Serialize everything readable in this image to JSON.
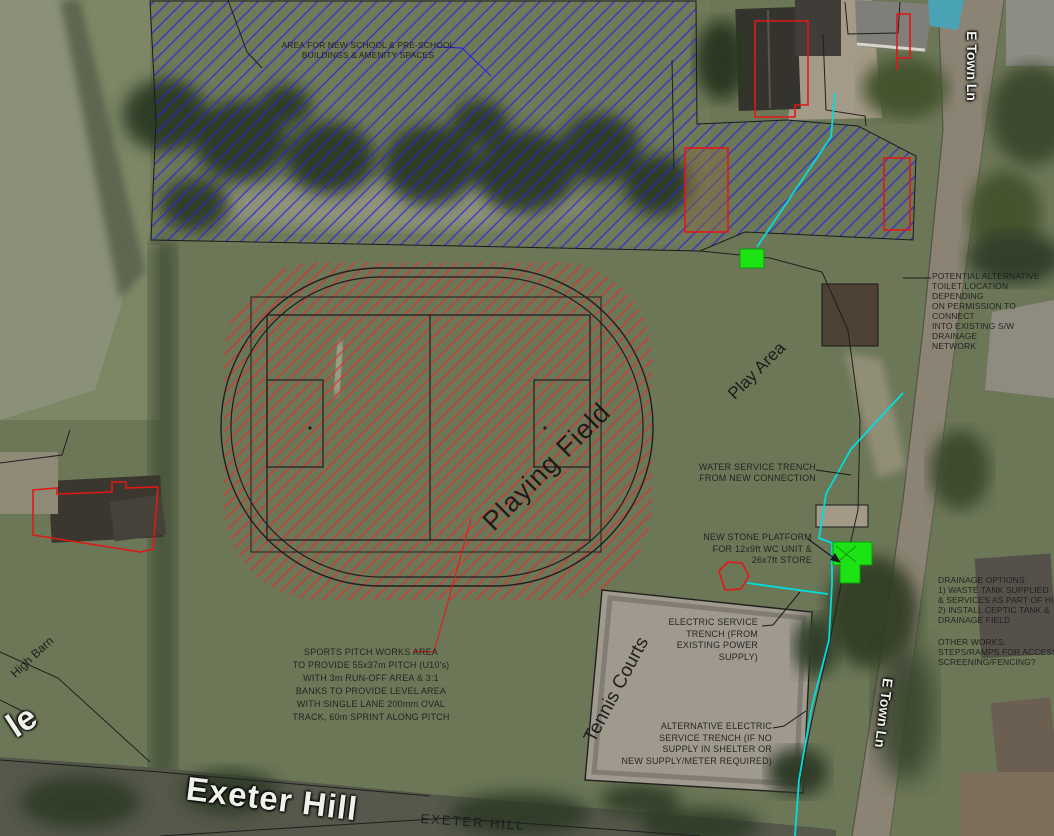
{
  "canvas": {
    "width": 1054,
    "height": 836
  },
  "annotations": {
    "school_area": "AREA FOR NEW SCHOOL & PRE-SCHOOL\nBUILDINGS & AMENITY SPACES",
    "toilet_location": "POTENTIAL ALTERNATIVE\nTOILET LOCATION DEPENDING\nON PERMISSION TO CONNECT\nINTO EXISTING S/W DRAINAGE\nNETWORK",
    "water_trench": "WATER SERVICE TRENCH\nFROM NEW CONNECTION",
    "stone_platform": "NEW STONE PLATFORM\nFOR 12x9ft WC UNIT &\n26x7ft STORE",
    "drainage_options": "DRAINAGE OPTIONS:\n1) WASTE TANK SUPPLIED\n& SERVICES AS PART OF HI\n2) INSTALL CEPTIC TANK &\nDRAINAGE FIELD",
    "other_works": "OTHER WORKS:\nSTEPS/RAMPS FOR ACCESS\nSCREENING/FENCING?",
    "electric_trench": "ELECTRIC SERVICE\nTRENCH (FROM\nEXISTING POWER SUPPLY)",
    "alt_electric_trench": "ALTERNATIVE ELECTRIC\nSERVICE TRENCH (IF NO\nSUPPLY IN SHELTER OR\nNEW SUPPLY/METER REQUIRED)",
    "sports_pitch": "SPORTS PITCH WORKS AREA\nTO PROVIDE 55x37m PITCH (U10's)\nWITH 3m RUN-OFF AREA & 3:1\nBANKS TO PROVIDE LEVEL AREA\nWITH SINGLE LANE 200mm OVAL\nTRACK, 60m SPRINT ALONG PITCH"
  },
  "site_labels": {
    "playing_field": "Playing Field",
    "play_area": "Play Area",
    "tennis_courts": "Tennis Courts",
    "high_barn": "High Barn"
  },
  "road_labels": {
    "exeter_hill_photo": "Exeter Hill",
    "exeter_hill_cad": "EXETER HILL",
    "e_town_ln_north": "E Town Ln",
    "e_town_ln_south": "E Town Ln",
    "partial_west_road": "le"
  },
  "legend_colors": {
    "school_area_hatch_blue": "#2626e0",
    "sports_works_hatch_red": "#e03030",
    "service_trench_cyan": "#00dede",
    "new_platform_green": "#1de214",
    "outline_red": "#e01818"
  }
}
